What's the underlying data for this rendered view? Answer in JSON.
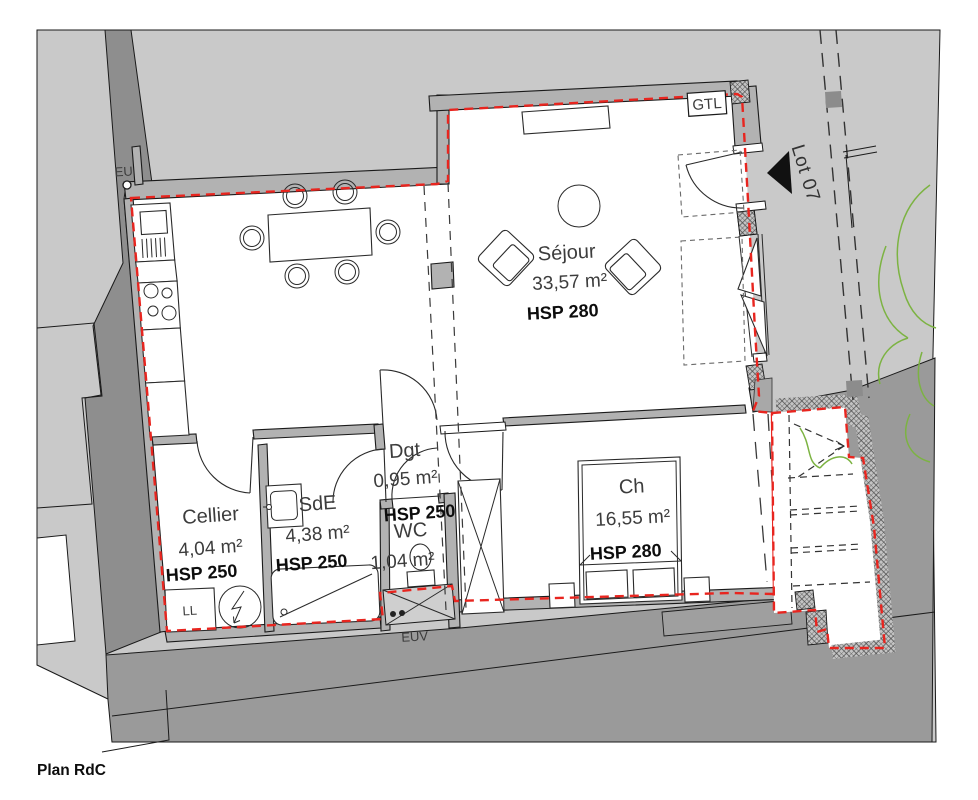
{
  "document": {
    "type": "floor-plan",
    "footer_label": "Plan RdC"
  },
  "rooms": [
    {
      "id": "sejour",
      "name": "Séjour",
      "area": "33,57 m²",
      "ceiling": "HSP 280"
    },
    {
      "id": "chambre",
      "name": "Ch",
      "area": "16,55 m²",
      "ceiling": "HSP 280"
    },
    {
      "id": "cellier",
      "name": "Cellier",
      "area": "4,04 m²",
      "ceiling": "HSP 250"
    },
    {
      "id": "sde",
      "name": "SdE",
      "area": "4,38 m²",
      "ceiling": "HSP 250"
    },
    {
      "id": "degagement",
      "name": "Dgt",
      "area": "0,95 m²",
      "ceiling": "HSP 250"
    },
    {
      "id": "wc",
      "name": "WC",
      "area": "1,04 m²"
    }
  ],
  "annotations": {
    "lot": "Lot 07",
    "gtl": "GTL",
    "eu": "EU",
    "euv": "EUV",
    "washing_machine": "LL"
  },
  "colors": {
    "outline_red": "#e8251f",
    "site_gray": "#c9c9c9",
    "street_gray": "#9a9a9a",
    "band_gray": "#8e8e8e",
    "wall_gray": "#b2b2b2",
    "plant_green": "#7cb342"
  }
}
